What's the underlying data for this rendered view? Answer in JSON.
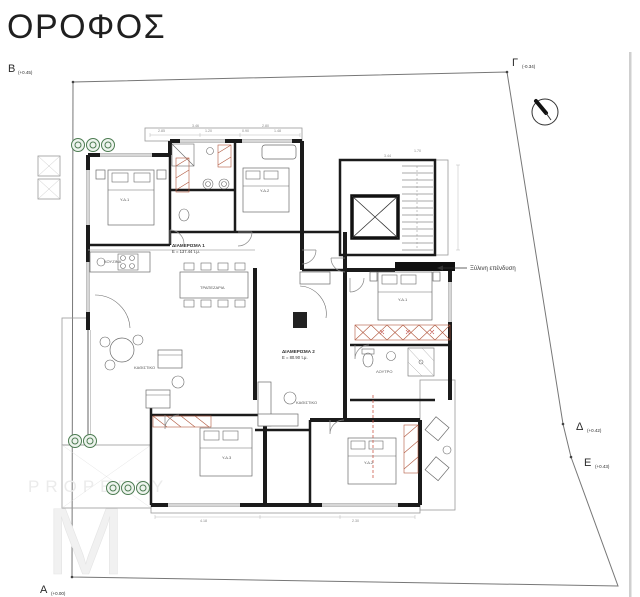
{
  "title": "ΟΡΟΦΟΣ",
  "boundary": {
    "markers": [
      {
        "letter": "Β",
        "elevation": "(+0.45)"
      },
      {
        "letter": "Γ",
        "elevation": "(-0.34)"
      },
      {
        "letter": "Δ",
        "elevation": "(+0.42)"
      },
      {
        "letter": "Ε",
        "elevation": "(+0.43)"
      },
      {
        "letter": "Α",
        "elevation": "(+0.00)"
      }
    ]
  },
  "apartments": [
    {
      "name": "ΔΙΑΜΕΡΙΣΜΑ 1",
      "area": "Ε = 137.44 τ.μ."
    },
    {
      "name": "ΔΙΑΜΕΡΙΣΜΑ 2",
      "area": "Ε = 80.90 τ.μ."
    }
  ],
  "annotation_label": "Ξύλινη επένδυση",
  "watermark": {
    "text": "PROPERTY",
    "monogram": "M"
  },
  "rooms": [
    "Υ.Δ.1",
    "Υ.Δ.2",
    "Υ.Δ.3",
    "ΚΑΘΙΣΤΙΚΟ",
    "ΚΟΥΖΙΝΑ",
    "ΤΡΑΠΕΖΑΡΙΑ",
    "ΚΑΘΙΣΤΙΚΟ",
    "ΛΟΥΤΡΟ",
    "Υ.Δ.1",
    "Υ.Δ.2"
  ],
  "dimensions": [
    "3.46",
    "2.85",
    "1.20",
    "0.90",
    "1.48",
    "2.80",
    "1.70",
    "3.44",
    "2.30",
    "4.18"
  ],
  "colors": {
    "wall": "#1b1b1b",
    "accent_red": "#b2593f",
    "plant_green": "#4d7c52",
    "watermark_gray": "#ebebeb"
  }
}
